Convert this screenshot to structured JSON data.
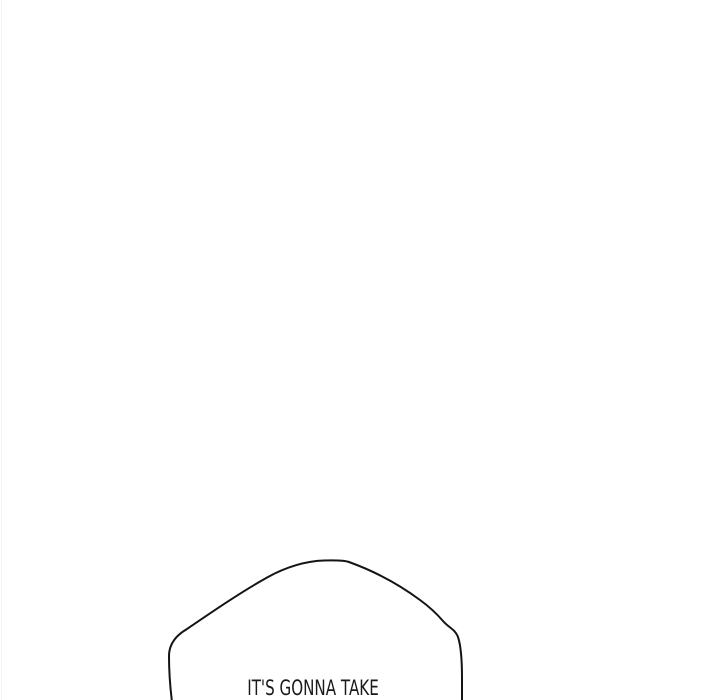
{
  "page": {
    "background_color": "#ffffff",
    "width_px": 720,
    "height_px": 700
  },
  "panel": {
    "speech_bubble": {
      "text": "IT'S GONNA TAKE",
      "outline_color": "#141414",
      "fill_color": "#ffffff",
      "text_color": "#1a1a1a",
      "clipped_at_bottom": true
    }
  }
}
